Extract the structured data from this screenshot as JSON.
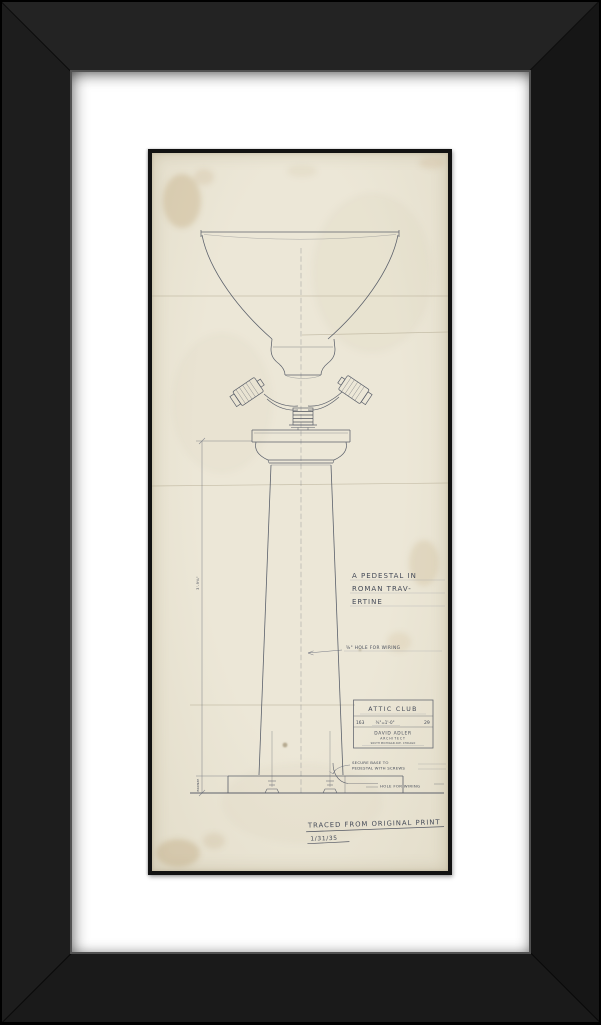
{
  "artwork_frame": {
    "frame_color": "#1d1d1d",
    "mat_color": "#ffffff",
    "paper_color": "#e8e3d3",
    "pencil_color": "#4c5260"
  },
  "drawing": {
    "title_lines": [
      "A PEDESTAL IN",
      "ROMAN TRAV-",
      "ERTINE"
    ],
    "note_wiring_upper": "⅝\" HOLE FOR WIRING",
    "note_secure_line1": "SECURE BASE TO",
    "note_secure_line2": "PEDESTAL WITH SCREWS",
    "note_wiring_lower": "HOLE FOR WIRING",
    "dim_shaft": "3'-9¾\"",
    "dim_base": "BRONZE",
    "title_block": {
      "project": "ATTIC CLUB",
      "job_no": "163",
      "scale": "¾\"=1'-0\"",
      "sheet_no": "29",
      "architect": "DAVID ADLER",
      "architect_title": "ARCHITECT",
      "address": "SOUTH MICHIGAN AVE. CHICAGO"
    },
    "traced_note": "TRACED FROM ORIGINAL PRINT",
    "traced_date": "1/31/35"
  }
}
